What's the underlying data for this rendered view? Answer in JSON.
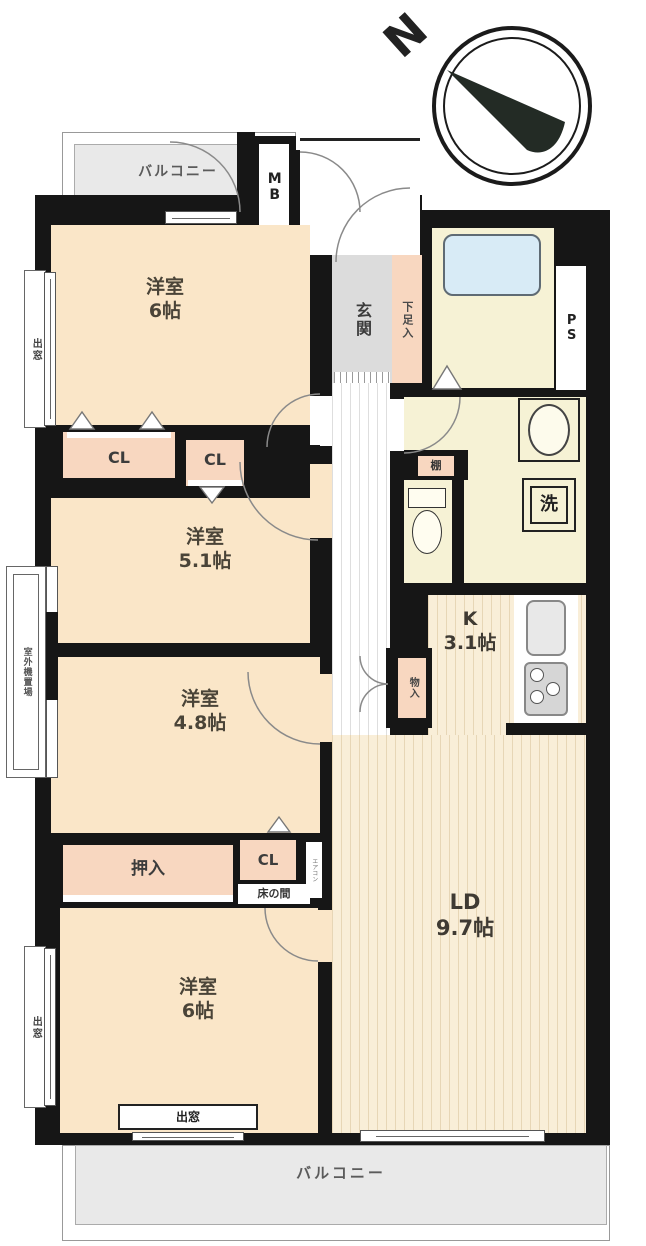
{
  "compass": {
    "north_label": "N"
  },
  "areas": {
    "balcony_top": "バルコニー",
    "balcony_bottom": "バルコニー",
    "meter_box": "MB",
    "entrance": "玄関",
    "shoe_cabinet": "下足入",
    "pipe_space": "PS",
    "bay_window_left_top": "出窓",
    "bay_window_left_bottom": "出窓",
    "bay_window_bottom": "出窓",
    "outdoor_unit_space": "室外機置場",
    "closet_top_1": "CL",
    "closet_top_2": "CL",
    "closet_bottom": "CL",
    "oshiire": "押入",
    "tokonoma": "床の間",
    "storage": "物入",
    "shelf": "棚",
    "laundry": "洗",
    "aircon_note": "エアコン"
  },
  "rooms": {
    "western_room_1": {
      "name": "洋室",
      "size": "6帖"
    },
    "western_room_2": {
      "name": "洋室",
      "size": "5.1帖"
    },
    "western_room_3": {
      "name": "洋室",
      "size": "4.8帖"
    },
    "western_room_4": {
      "name": "洋室",
      "size": "6帖"
    },
    "kitchen": {
      "name": "K",
      "size": "3.1帖"
    },
    "living_dining": {
      "name": "LD",
      "size": "9.7帖"
    }
  },
  "colors": {
    "wall": "#161616",
    "room_floor": "#fae6c8",
    "closet": "#f8d7c0",
    "wet_area": "#f6f2d5",
    "bathtub": "#d8ebf6",
    "balcony": "#e9e9e9"
  }
}
